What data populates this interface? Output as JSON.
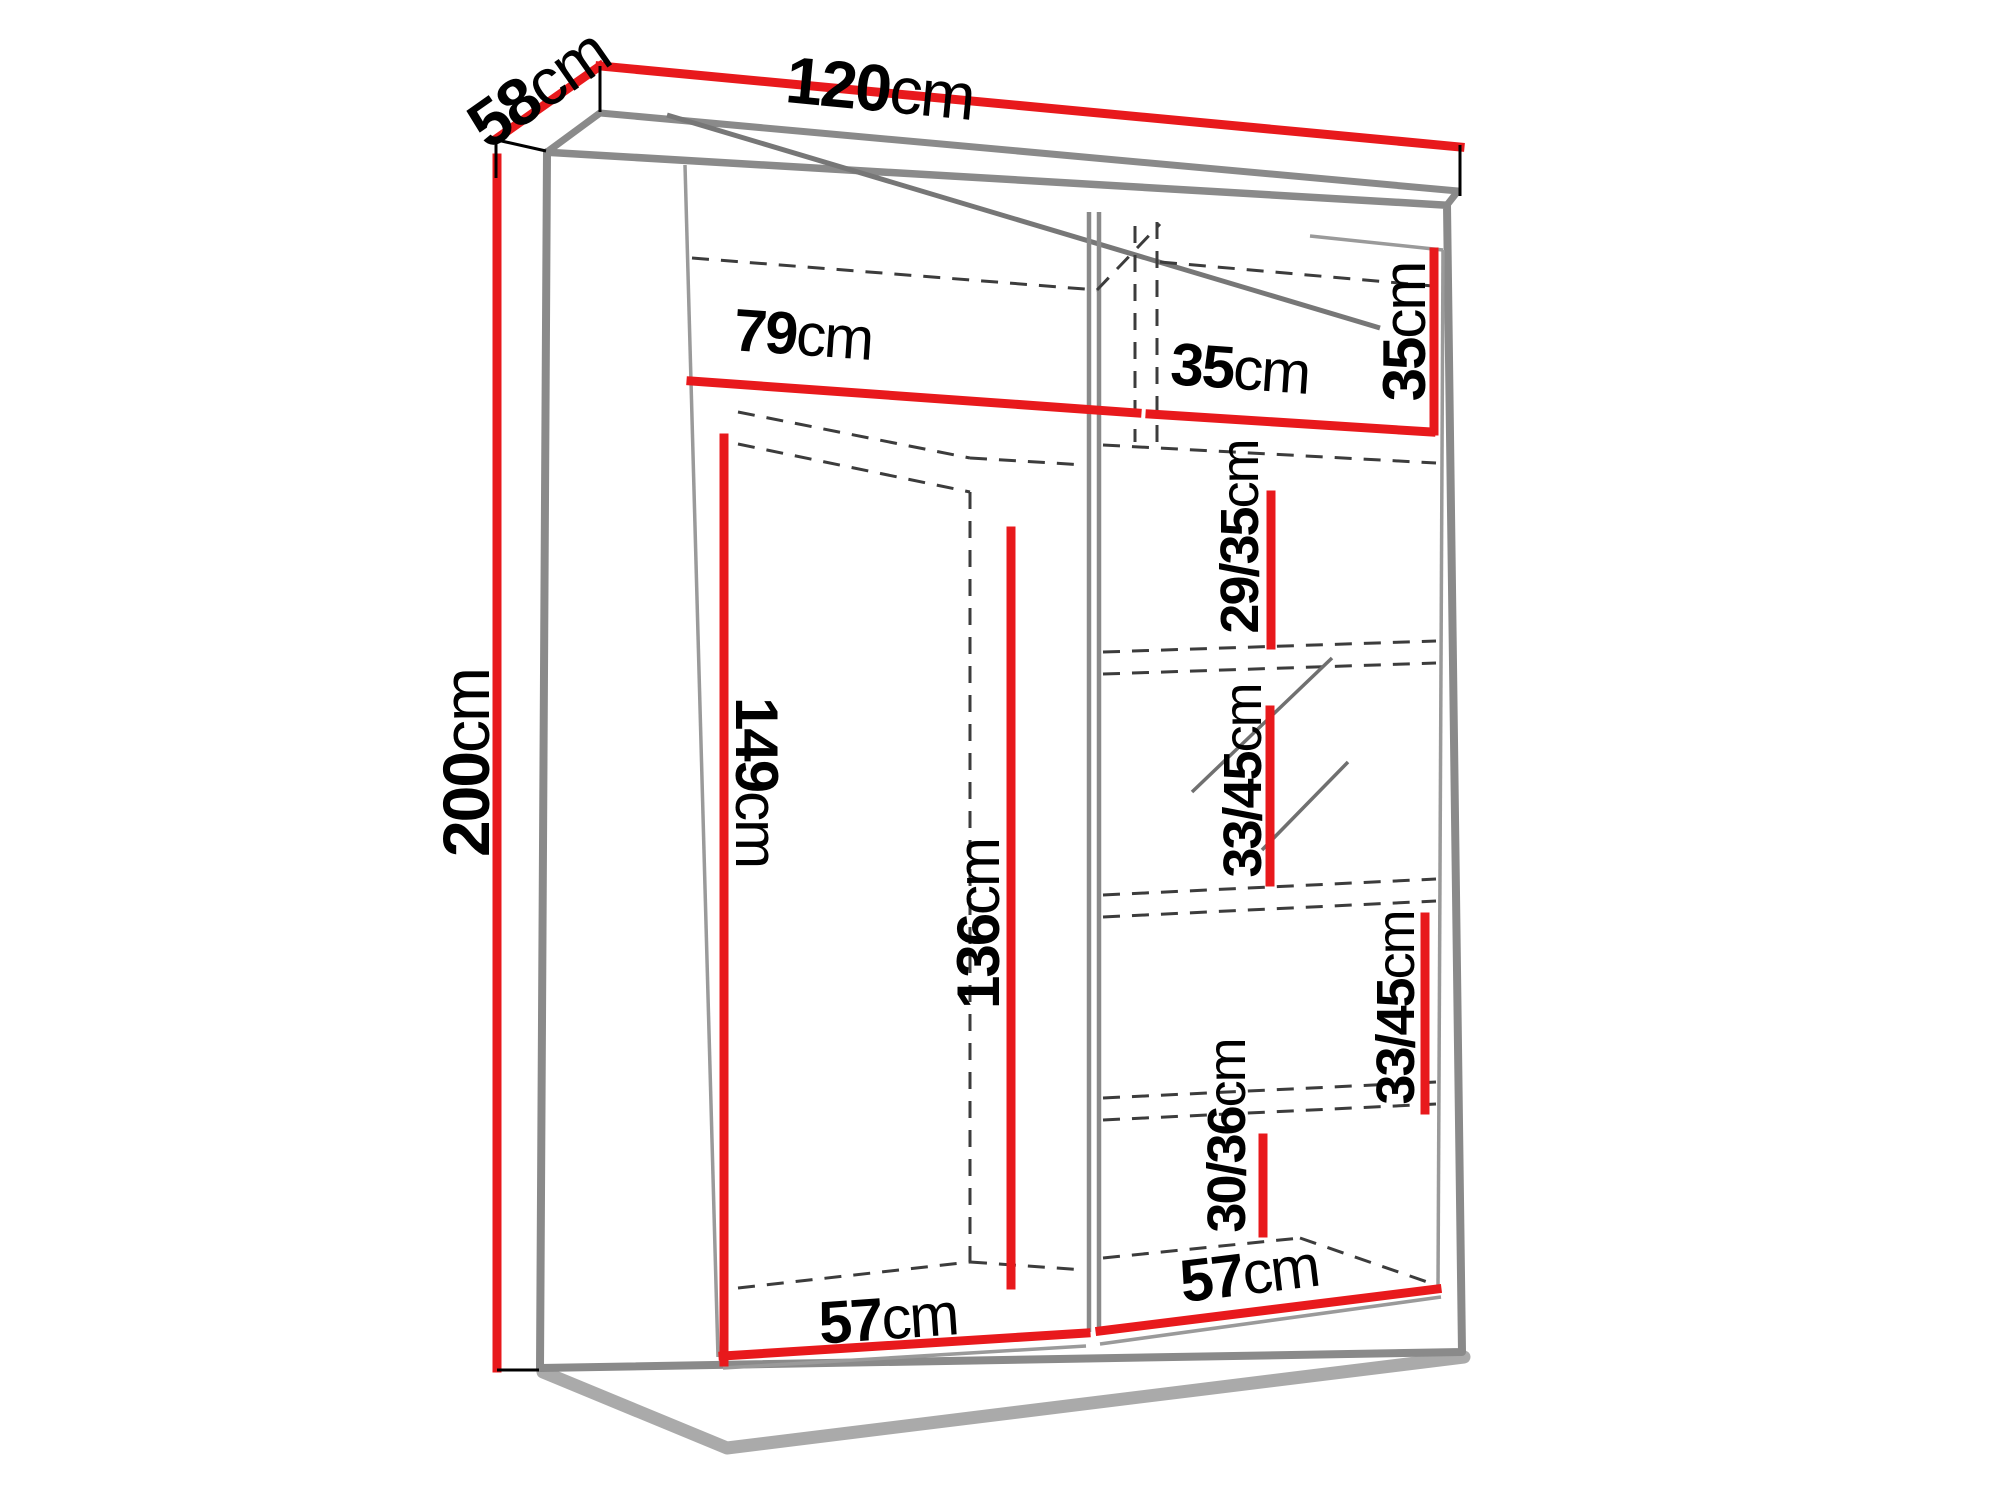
{
  "diagram": {
    "kind": "wardrobe dimension drawing",
    "unit": "cm",
    "style": "3d outline with dashed interior lines and red dimension lines"
  },
  "colors": {
    "dimension": "#e8191c",
    "outline": "#8a8a8a",
    "dashes": "#3c3c3c",
    "label": "#000000",
    "paper": "#ffffff"
  },
  "labels": {
    "width": {
      "value": "120",
      "unit": "cm"
    },
    "depth": {
      "value": "58",
      "unit": "cm"
    },
    "height": {
      "value": "200",
      "unit": "cm"
    },
    "top_left_width": {
      "value": "79",
      "unit": "cm"
    },
    "top_right_width": {
      "value": "35",
      "unit": "cm"
    },
    "top_height": {
      "value": "35",
      "unit": "cm"
    },
    "shelf_gap_1": {
      "value": "29/35",
      "unit": "cm"
    },
    "shelf_gap_2": {
      "value": "33/45",
      "unit": "cm"
    },
    "shelf_gap_3": {
      "value": "33/45",
      "unit": "cm"
    },
    "shelf_gap_4": {
      "value": "30/36",
      "unit": "cm"
    },
    "left_height": {
      "value": "149",
      "unit": "cm"
    },
    "inner_height": {
      "value": "136",
      "unit": "cm"
    },
    "bottom_left": {
      "value": "57",
      "unit": "cm"
    },
    "bottom_right": {
      "value": "57",
      "unit": "cm"
    }
  }
}
